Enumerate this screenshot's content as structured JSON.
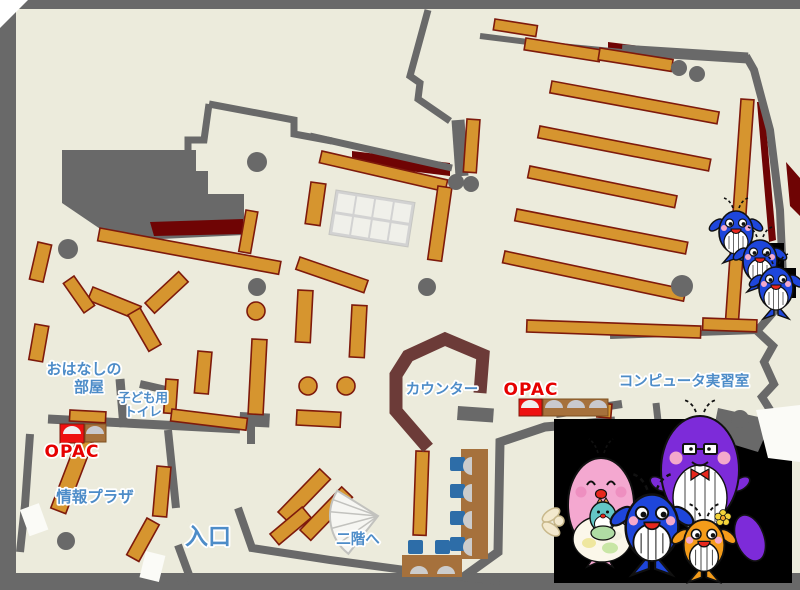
{
  "map": {
    "labels": {
      "storytelling_room": {
        "line1": "おはなしの",
        "line2": "部屋"
      },
      "kids_toilet": {
        "line1": "子ども用",
        "line2": "トイレ"
      },
      "opac_left": "OPAC",
      "opac_right": "OPAC",
      "info_plaza": "情報プラザ",
      "entrance": "入口",
      "stairs_up": "二階へ",
      "counter": "カウンター",
      "computer_room": "コンピュータ実習室"
    },
    "palette": {
      "floor": "#ECEBDC",
      "wall": "#696969",
      "shelfFill": "#D6952F",
      "shelfStroke": "#7E1A0C",
      "accentDarkRed": "#6F0404",
      "counter": "#6C3B38",
      "labelBlue": "#4D8CC8",
      "labelRed": "#E60000",
      "labelOutline": "#FFFFFF",
      "tableGrid": "#D2D2D2",
      "tableCell": "#F0F0EA",
      "deskBrown": "#A6713C",
      "chairBlue": "#2D6DA8",
      "seatGray": "#CCCCCC",
      "opacRed": "#EE1111",
      "opacDomeLight": "#EFEFEF",
      "opacDomeGray": "#C9C9CE",
      "doorWhite": "#FBFBF7",
      "stairFill": "#F6F6F2",
      "stairStroke": "#C2C2BE",
      "panelBlack": "#000000",
      "whaleBlue": "#1E46DB",
      "whalePurple": "#7D2BD9",
      "whalePink": "#F4A8D0",
      "whaleOrange": "#F49C1A",
      "babyTeal": "#63C6C6",
      "mouthRed": "#E8281E",
      "cheekPink": "#F4A9CB"
    },
    "mascots": {
      "family_panel": {
        "background": "#000000",
        "members": [
          "purple-whale-parent",
          "pink-whale-parent",
          "teal-baby-whale",
          "blue-whale-child",
          "orange-whale-child"
        ]
      },
      "stair_whales": {
        "count": 3,
        "color": "#1E46DB"
      }
    }
  }
}
